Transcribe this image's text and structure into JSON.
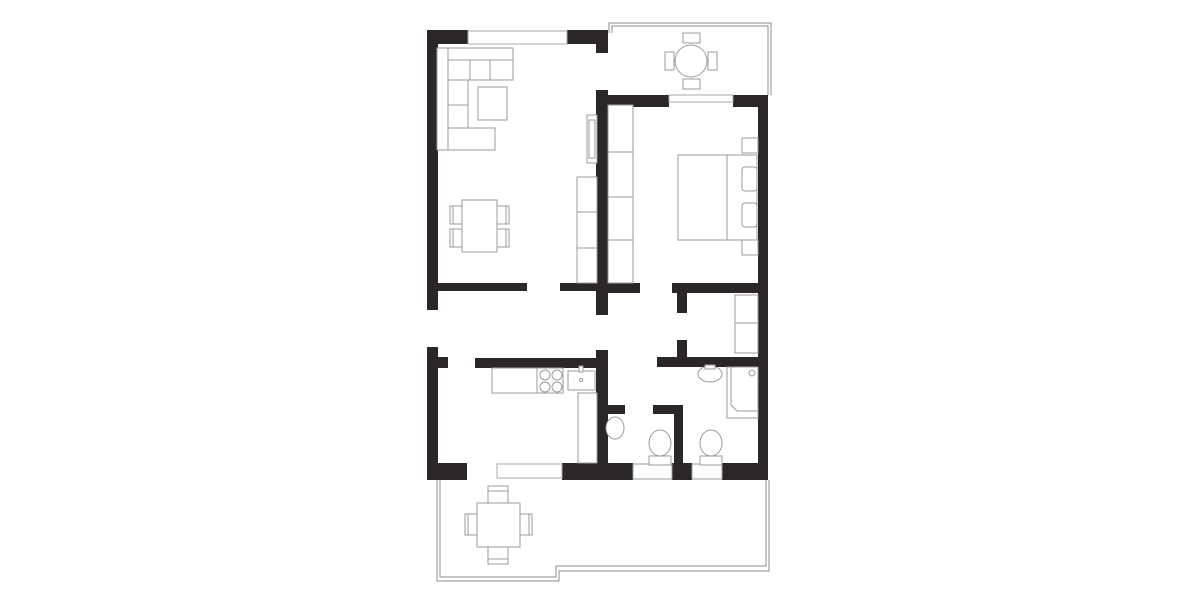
{
  "canvas": {
    "width": 1200,
    "height": 600,
    "background": "#ffffff"
  },
  "colors": {
    "wall": "#2b2627",
    "furniture_line": "#9b9b9b",
    "outline": "#8b8d8f",
    "glass_line": "#a8a8a8",
    "paper": "#ffffff"
  },
  "shapes": [
    {
      "n": "balcony-outline-outer",
      "t": "poly",
      "pts": "609,33 609,23 771,23 771,95",
      "c": "outline"
    },
    {
      "n": "balcony-outline-inner",
      "t": "poly",
      "pts": "612,33 612,26 768,26 768,95",
      "c": "outline"
    },
    {
      "n": "terrace-outline-outer",
      "t": "poly",
      "pts": "437,480 437,581 559,581 559,571 769,571 769,480",
      "c": "outline"
    },
    {
      "n": "terrace-outline-inner",
      "t": "poly",
      "pts": "440,480 440,577 556,577 556,566 766,566 766,480",
      "c": "outline"
    },
    {
      "n": "wall-top-left",
      "t": "rect",
      "x": 427,
      "y": 30,
      "w": 41,
      "h": 14,
      "c": "wall"
    },
    {
      "n": "wall-top-right",
      "t": "rect",
      "x": 567,
      "y": 30,
      "w": 41,
      "h": 14,
      "c": "wall"
    },
    {
      "n": "wall-central-top",
      "t": "rect",
      "x": 596,
      "y": 30,
      "w": 12,
      "h": 23,
      "c": "wall"
    },
    {
      "n": "wall-central-upper",
      "t": "rect",
      "x": 596,
      "y": 90,
      "w": 12,
      "h": 225,
      "c": "wall"
    },
    {
      "n": "wall-central-lower",
      "t": "rect",
      "x": 596,
      "y": 350,
      "w": 12,
      "h": 130,
      "c": "wall"
    },
    {
      "n": "wall-left-upper",
      "t": "rect",
      "x": 427,
      "y": 30,
      "w": 11,
      "h": 280,
      "c": "wall"
    },
    {
      "n": "wall-left-lower",
      "t": "rect",
      "x": 427,
      "y": 347,
      "w": 11,
      "h": 133,
      "c": "wall"
    },
    {
      "n": "wall-kitchen-stub-left",
      "t": "rect",
      "x": 438,
      "y": 357,
      "w": 10,
      "h": 11,
      "c": "wall"
    },
    {
      "n": "wall-living-bottom-a",
      "t": "rect",
      "x": 438,
      "y": 283,
      "w": 89,
      "h": 8,
      "c": "wall"
    },
    {
      "n": "wall-living-bottom-b",
      "t": "rect",
      "x": 560,
      "y": 283,
      "w": 36,
      "h": 8,
      "c": "wall"
    },
    {
      "n": "wall-kitchen-top",
      "t": "rect",
      "x": 475,
      "y": 358,
      "w": 133,
      "h": 10,
      "c": "wall"
    },
    {
      "n": "wall-bedroom-top-left",
      "t": "rect",
      "x": 608,
      "y": 95,
      "w": 61,
      "h": 12,
      "c": "wall"
    },
    {
      "n": "wall-bedroom-top-right",
      "t": "rect",
      "x": 733,
      "y": 95,
      "w": 35,
      "h": 12,
      "c": "wall"
    },
    {
      "n": "wall-right",
      "t": "rect",
      "x": 758,
      "y": 95,
      "w": 10,
      "h": 385,
      "c": "wall"
    },
    {
      "n": "wall-bedroom-bottom-left",
      "t": "rect",
      "x": 608,
      "y": 283,
      "w": 32,
      "h": 10,
      "c": "wall"
    },
    {
      "n": "wall-bedroom-bottom-right",
      "t": "rect",
      "x": 672,
      "y": 283,
      "w": 86,
      "h": 10,
      "c": "wall"
    },
    {
      "n": "wall-closet-stub-upper",
      "t": "rect",
      "x": 677,
      "y": 293,
      "w": 10,
      "h": 20,
      "c": "wall"
    },
    {
      "n": "wall-closet-stub-lower",
      "t": "rect",
      "x": 677,
      "y": 340,
      "w": 10,
      "h": 17,
      "c": "wall"
    },
    {
      "n": "wall-bathroom-top",
      "t": "rect",
      "x": 657,
      "y": 357,
      "w": 101,
      "h": 10,
      "c": "wall"
    },
    {
      "n": "wall-wc-divider",
      "t": "rect",
      "x": 674,
      "y": 405,
      "w": 9,
      "h": 75,
      "c": "wall"
    },
    {
      "n": "wall-wc1-stub-left",
      "t": "rect",
      "x": 608,
      "y": 405,
      "w": 17,
      "h": 9,
      "c": "wall"
    },
    {
      "n": "wall-wc1-stub-right",
      "t": "rect",
      "x": 653,
      "y": 405,
      "w": 30,
      "h": 9,
      "c": "wall"
    },
    {
      "n": "wall-bottom-a",
      "t": "rect",
      "x": 427,
      "y": 463,
      "w": 40,
      "h": 17,
      "c": "wall"
    },
    {
      "n": "wall-bottom-b",
      "t": "rect",
      "x": 562,
      "y": 463,
      "w": 71,
      "h": 17,
      "c": "wall"
    },
    {
      "n": "wall-bottom-c",
      "t": "rect",
      "x": 672,
      "y": 463,
      "w": 20,
      "h": 17,
      "c": "wall"
    },
    {
      "n": "wall-bottom-d",
      "t": "rect",
      "x": 722,
      "y": 463,
      "w": 46,
      "h": 17,
      "c": "wall"
    },
    {
      "n": "window-living-top",
      "t": "rect",
      "x": 468,
      "y": 31,
      "w": 99,
      "h": 13,
      "c": "glass"
    },
    {
      "n": "window-bedroom-sill",
      "t": "rect",
      "x": 669,
      "y": 95,
      "w": 64,
      "h": 7,
      "c": "glass"
    },
    {
      "n": "door-terrace-slider",
      "t": "rect",
      "x": 497,
      "y": 464,
      "w": 65,
      "h": 14,
      "c": "glass"
    },
    {
      "n": "niche-wc-toilet",
      "t": "rect",
      "x": 633,
      "y": 464,
      "w": 39,
      "h": 15,
      "c": "niche"
    },
    {
      "n": "niche-bathroom-toilet",
      "t": "rect",
      "x": 692,
      "y": 464,
      "w": 30,
      "h": 15,
      "c": "niche"
    },
    {
      "n": "sofa-back-top",
      "t": "rect",
      "x": 437,
      "y": 48,
      "w": 76,
      "h": 12,
      "c": "furn"
    },
    {
      "n": "sofa-back-left",
      "t": "rect",
      "x": 437,
      "y": 48,
      "w": 11,
      "h": 102,
      "c": "furn"
    },
    {
      "n": "sofa-seat-row",
      "t": "rect",
      "x": 448,
      "y": 60,
      "w": 65,
      "h": 20,
      "c": "furn"
    },
    {
      "n": "sofa-seat-divider-1",
      "t": "line",
      "x1": 470,
      "y1": 60,
      "x2": 470,
      "y2": 80,
      "c": "fline"
    },
    {
      "n": "sofa-seat-divider-2",
      "t": "line",
      "x1": 490,
      "y1": 60,
      "x2": 490,
      "y2": 80,
      "c": "fline"
    },
    {
      "n": "sofa-seat-column",
      "t": "rect",
      "x": 448,
      "y": 80,
      "w": 20,
      "h": 70,
      "c": "furn"
    },
    {
      "n": "sofa-seat-column-divider-1",
      "t": "line",
      "x1": 448,
      "y1": 105,
      "x2": 468,
      "y2": 105,
      "c": "fline"
    },
    {
      "n": "sofa-seat-column-divider-2",
      "t": "line",
      "x1": 448,
      "y1": 128,
      "x2": 468,
      "y2": 128,
      "c": "fline"
    },
    {
      "n": "sofa-seat-bottom",
      "t": "rect",
      "x": 448,
      "y": 128,
      "w": 47,
      "h": 22,
      "c": "furn"
    },
    {
      "n": "sofa-coffee-table",
      "t": "rect",
      "x": 478,
      "y": 87,
      "w": 29,
      "h": 33,
      "c": "furn"
    },
    {
      "n": "dining-chair-1",
      "t": "rect",
      "x": 450,
      "y": 206,
      "w": 12,
      "h": 18,
      "c": "furn"
    },
    {
      "n": "dining-chair-1-back",
      "t": "line",
      "x1": 453,
      "y1": 206,
      "x2": 453,
      "y2": 224,
      "c": "fline"
    },
    {
      "n": "dining-chair-2",
      "t": "rect",
      "x": 450,
      "y": 229,
      "w": 12,
      "h": 18,
      "c": "furn"
    },
    {
      "n": "dining-chair-2-back",
      "t": "line",
      "x1": 453,
      "y1": 229,
      "x2": 453,
      "y2": 247,
      "c": "fline"
    },
    {
      "n": "dining-chair-3",
      "t": "rect",
      "x": 497,
      "y": 206,
      "w": 12,
      "h": 18,
      "c": "furn"
    },
    {
      "n": "dining-chair-3-back",
      "t": "line",
      "x1": 506,
      "y1": 206,
      "x2": 506,
      "y2": 224,
      "c": "fline"
    },
    {
      "n": "dining-chair-4",
      "t": "rect",
      "x": 497,
      "y": 229,
      "w": 12,
      "h": 18,
      "c": "furn"
    },
    {
      "n": "dining-chair-4-back",
      "t": "line",
      "x1": 506,
      "y1": 229,
      "x2": 506,
      "y2": 247,
      "c": "fline"
    },
    {
      "n": "dining-table",
      "t": "rect",
      "x": 462,
      "y": 200,
      "w": 35,
      "h": 52,
      "c": "furn"
    },
    {
      "n": "tv-unit-outer",
      "t": "rect",
      "x": 587,
      "y": 115,
      "w": 10,
      "h": 48,
      "c": "furn"
    },
    {
      "n": "tv-unit-inner",
      "t": "rect",
      "x": 589,
      "y": 120,
      "w": 6,
      "h": 38,
      "c": "furn"
    },
    {
      "n": "sideboard",
      "t": "rect",
      "x": 577,
      "y": 177,
      "w": 20,
      "h": 106,
      "c": "furn"
    },
    {
      "n": "sideboard-divider-1",
      "t": "line",
      "x1": 577,
      "y1": 212,
      "x2": 597,
      "y2": 212,
      "c": "fline"
    },
    {
      "n": "sideboard-divider-2",
      "t": "line",
      "x1": 577,
      "y1": 248,
      "x2": 597,
      "y2": 248,
      "c": "fline"
    },
    {
      "n": "hall-wardrobe",
      "t": "rect",
      "x": 608,
      "y": 105,
      "w": 25,
      "h": 178,
      "c": "furn"
    },
    {
      "n": "hall-wardrobe-divider-1",
      "t": "line",
      "x1": 608,
      "y1": 152,
      "x2": 633,
      "y2": 152,
      "c": "fline"
    },
    {
      "n": "hall-wardrobe-divider-2",
      "t": "line",
      "x1": 608,
      "y1": 197,
      "x2": 633,
      "y2": 197,
      "c": "fline"
    },
    {
      "n": "hall-wardrobe-divider-3",
      "t": "line",
      "x1": 608,
      "y1": 240,
      "x2": 633,
      "y2": 240,
      "c": "fline"
    },
    {
      "n": "bed",
      "t": "rect",
      "x": 678,
      "y": 155,
      "w": 79,
      "h": 85,
      "c": "furn"
    },
    {
      "n": "bed-head-line",
      "t": "line",
      "x1": 727,
      "y1": 155,
      "x2": 727,
      "y2": 240,
      "c": "fline"
    },
    {
      "n": "bed-pillow-1",
      "t": "rect",
      "x": 742,
      "y": 167,
      "w": 15,
      "h": 24,
      "rx": 3,
      "c": "furn"
    },
    {
      "n": "bed-pillow-2",
      "t": "rect",
      "x": 742,
      "y": 203,
      "w": 15,
      "h": 24,
      "rx": 3,
      "c": "furn"
    },
    {
      "n": "nightstand-1",
      "t": "rect",
      "x": 742,
      "y": 138,
      "w": 16,
      "h": 15,
      "c": "furn"
    },
    {
      "n": "nightstand-2",
      "t": "rect",
      "x": 742,
      "y": 240,
      "w": 16,
      "h": 15,
      "c": "furn"
    },
    {
      "n": "balcony-chair-top",
      "t": "rect",
      "x": 683,
      "y": 33,
      "w": 17,
      "h": 10,
      "c": "furn"
    },
    {
      "n": "balcony-chair-bottom",
      "t": "rect",
      "x": 683,
      "y": 79,
      "w": 17,
      "h": 10,
      "c": "furn"
    },
    {
      "n": "balcony-chair-left",
      "t": "rect",
      "x": 665,
      "y": 52,
      "w": 9,
      "h": 18,
      "c": "furn"
    },
    {
      "n": "balcony-chair-right",
      "t": "rect",
      "x": 708,
      "y": 52,
      "w": 9,
      "h": 18,
      "c": "furn"
    },
    {
      "n": "balcony-table",
      "t": "circle",
      "cx": 691,
      "cy": 61,
      "r": 16,
      "c": "furn"
    },
    {
      "n": "closet-shelf",
      "t": "rect",
      "x": 735,
      "y": 295,
      "w": 23,
      "h": 58,
      "c": "furn"
    },
    {
      "n": "closet-shelf-divider",
      "t": "line",
      "x1": 735,
      "y1": 323,
      "x2": 758,
      "y2": 323,
      "c": "fline"
    },
    {
      "n": "shower",
      "t": "rect",
      "x": 727,
      "y": 367,
      "w": 31,
      "h": 51,
      "c": "furn"
    },
    {
      "n": "shower-inner-edge",
      "t": "poly",
      "pts": "758,411 737,411 731,405 731,367",
      "c": "fline"
    },
    {
      "n": "shower-drain",
      "t": "circle",
      "cx": 752,
      "cy": 373,
      "r": 3,
      "c": "furn"
    },
    {
      "n": "bathroom-sink",
      "t": "ellipse",
      "cx": 710,
      "cy": 374,
      "rx": 12,
      "ry": 8,
      "c": "furn"
    },
    {
      "n": "bathroom-sink-tap",
      "t": "rect",
      "x": 705,
      "y": 365,
      "w": 10,
      "h": 4,
      "c": "furn"
    },
    {
      "n": "bathroom-toilet-tank",
      "t": "rect",
      "x": 700,
      "y": 456,
      "w": 22,
      "h": 9,
      "c": "furn"
    },
    {
      "n": "bathroom-toilet-bowl",
      "t": "ellipse",
      "cx": 711,
      "cy": 443,
      "rx": 11,
      "ry": 13,
      "c": "furn"
    },
    {
      "n": "wc-sink",
      "t": "ellipse",
      "cx": 615,
      "cy": 428,
      "rx": 9,
      "ry": 11,
      "c": "furn"
    },
    {
      "n": "wc-toilet-tank",
      "t": "rect",
      "x": 649,
      "y": 456,
      "w": 22,
      "h": 9,
      "c": "furn"
    },
    {
      "n": "wc-toilet-bowl",
      "t": "ellipse",
      "cx": 660,
      "cy": 443,
      "rx": 11,
      "ry": 13,
      "c": "furn"
    },
    {
      "n": "kitchen-counter",
      "t": "rect",
      "x": 492,
      "y": 368,
      "w": 71,
      "h": 25,
      "c": "furn"
    },
    {
      "n": "kitchen-counter-divider",
      "t": "line",
      "x1": 537,
      "y1": 368,
      "x2": 537,
      "y2": 393,
      "c": "fline"
    },
    {
      "n": "stove-burner-1",
      "t": "circle",
      "cx": 545,
      "cy": 375,
      "r": 5,
      "c": "furn"
    },
    {
      "n": "stove-burner-2",
      "t": "circle",
      "cx": 557,
      "cy": 375,
      "r": 5,
      "c": "furn"
    },
    {
      "n": "stove-burner-3",
      "t": "circle",
      "cx": 545,
      "cy": 387,
      "r": 5,
      "c": "furn"
    },
    {
      "n": "stove-burner-4",
      "t": "circle",
      "cx": 557,
      "cy": 387,
      "r": 5,
      "c": "furn"
    },
    {
      "n": "kitchen-sink",
      "t": "rect",
      "x": 568,
      "y": 371,
      "w": 27,
      "h": 19,
      "c": "furn"
    },
    {
      "n": "kitchen-sink-tap",
      "t": "rect",
      "x": 579,
      "y": 366,
      "w": 4,
      "h": 6,
      "c": "furn"
    },
    {
      "n": "kitchen-sink-dot",
      "t": "circle",
      "cx": 581,
      "cy": 380,
      "r": 1.5,
      "c": "fline"
    },
    {
      "n": "kitchen-counter-right",
      "t": "rect",
      "x": 578,
      "y": 393,
      "w": 19,
      "h": 70,
      "c": "furn"
    },
    {
      "n": "terrace-chair-top",
      "t": "rect",
      "x": 488,
      "y": 486,
      "w": 20,
      "h": 17,
      "c": "furn"
    },
    {
      "n": "terrace-chair-top-back",
      "t": "line",
      "x1": 488,
      "y1": 491,
      "x2": 508,
      "y2": 491,
      "c": "fline"
    },
    {
      "n": "terrace-chair-bottom",
      "t": "rect",
      "x": 488,
      "y": 547,
      "w": 20,
      "h": 17,
      "c": "furn"
    },
    {
      "n": "terrace-chair-bottom-back",
      "t": "line",
      "x1": 488,
      "y1": 559,
      "x2": 508,
      "y2": 559,
      "c": "fline"
    },
    {
      "n": "terrace-chair-left",
      "t": "rect",
      "x": 465,
      "y": 514,
      "w": 12,
      "h": 21,
      "c": "furn"
    },
    {
      "n": "terrace-chair-left-back",
      "t": "line",
      "x1": 468,
      "y1": 514,
      "x2": 468,
      "y2": 535,
      "c": "fline"
    },
    {
      "n": "terrace-chair-right",
      "t": "rect",
      "x": 520,
      "y": 514,
      "w": 12,
      "h": 21,
      "c": "furn"
    },
    {
      "n": "terrace-chair-right-back",
      "t": "line",
      "x1": 529,
      "y1": 514,
      "x2": 529,
      "y2": 535,
      "c": "fline"
    },
    {
      "n": "terrace-table",
      "t": "rect",
      "x": 477,
      "y": 503,
      "w": 43,
      "h": 44,
      "c": "furn"
    }
  ]
}
